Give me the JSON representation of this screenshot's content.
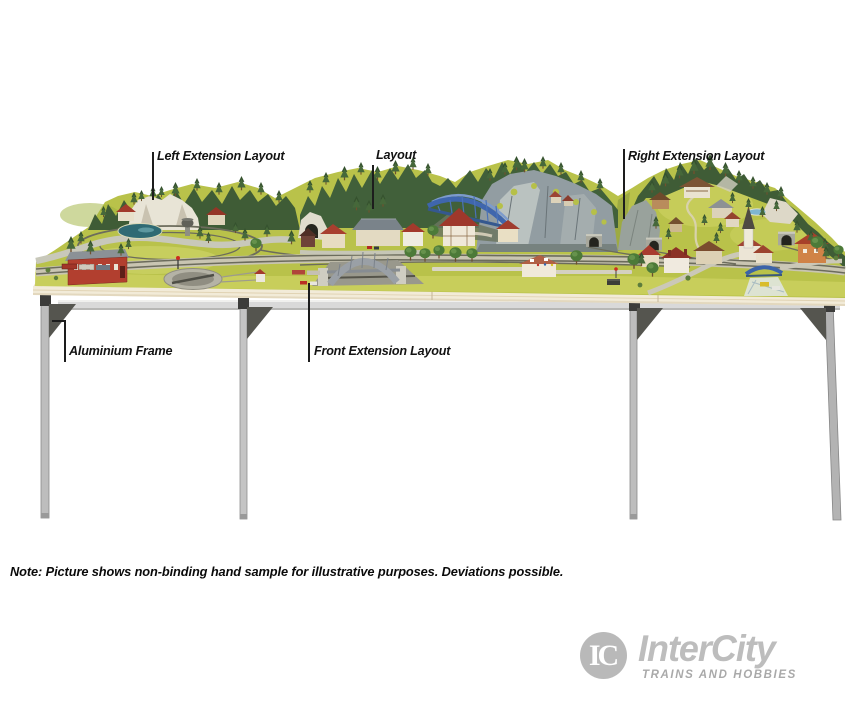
{
  "annotations": {
    "left_extension": "Left Extension Layout",
    "layout": "Layout",
    "right_extension": "Right Extension Layout",
    "aluminium_frame": "Aluminium Frame",
    "front_extension": "Front Extension Layout"
  },
  "note": "Note: Picture shows non-binding hand sample for illustrative purposes. Deviations possible.",
  "logo": {
    "monogram": "IC",
    "name": "InterCity",
    "tagline": "TRAINS AND HOBBIES",
    "color": "#bdbdbd"
  },
  "colors": {
    "grass": "#b9c24a",
    "table_wood": "#f2ebd8",
    "frame_aluminium": "#d9d9d9",
    "bracket_dark": "#3c3c3a",
    "truss_bridge_blue": "#3f66ad",
    "pond_teal": "#2f6a74",
    "rock_gray": "#929da2",
    "annotation_text": "#111111"
  }
}
